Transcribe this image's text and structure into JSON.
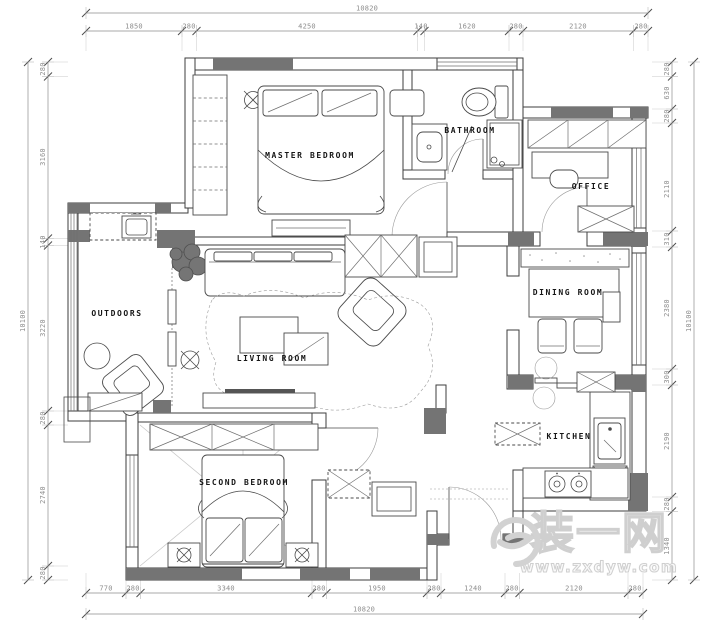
{
  "colors": {
    "background": "#ffffff",
    "wall_line": "#3d3d3d",
    "wall_fill": "#747474",
    "dim_text": "#8d8d8d",
    "label_text": "#161616",
    "watermark": "#cfcfcf"
  },
  "rooms": [
    {
      "name": "master-bedroom",
      "label": "MASTER BEDROOM"
    },
    {
      "name": "bathroom",
      "label": "BATHROOM"
    },
    {
      "name": "office",
      "label": "OFFICE"
    },
    {
      "name": "outdoors",
      "label": "OUTDOORS"
    },
    {
      "name": "living-room",
      "label": "LIVING ROOM"
    },
    {
      "name": "dining-room",
      "label": "DINING ROOM"
    },
    {
      "name": "kitchen",
      "label": "KITCHEN"
    },
    {
      "name": "second-bedroom",
      "label": "SECOND BEDROOM"
    }
  ],
  "dimensions": {
    "top": {
      "total": "10820",
      "segments": [
        "1850",
        "280",
        "4250",
        "140",
        "1620",
        "280",
        "2120",
        "280"
      ]
    },
    "bottom": {
      "total": "10820",
      "segments": [
        "770",
        "280",
        "3340",
        "280",
        "1950",
        "280",
        "1240",
        "280",
        "2120",
        "280"
      ]
    },
    "left": {
      "total": "10100",
      "segments": [
        "280",
        "3160",
        "140",
        "3220",
        "280",
        "2740",
        "280"
      ]
    },
    "right": {
      "total": "10100",
      "segments": [
        "280",
        "630",
        "280",
        "2110",
        "310",
        "2380",
        "300",
        "2190",
        "280",
        "1340"
      ]
    }
  },
  "watermark": {
    "brand": "装一网",
    "url": "www.zxdyw.com"
  }
}
